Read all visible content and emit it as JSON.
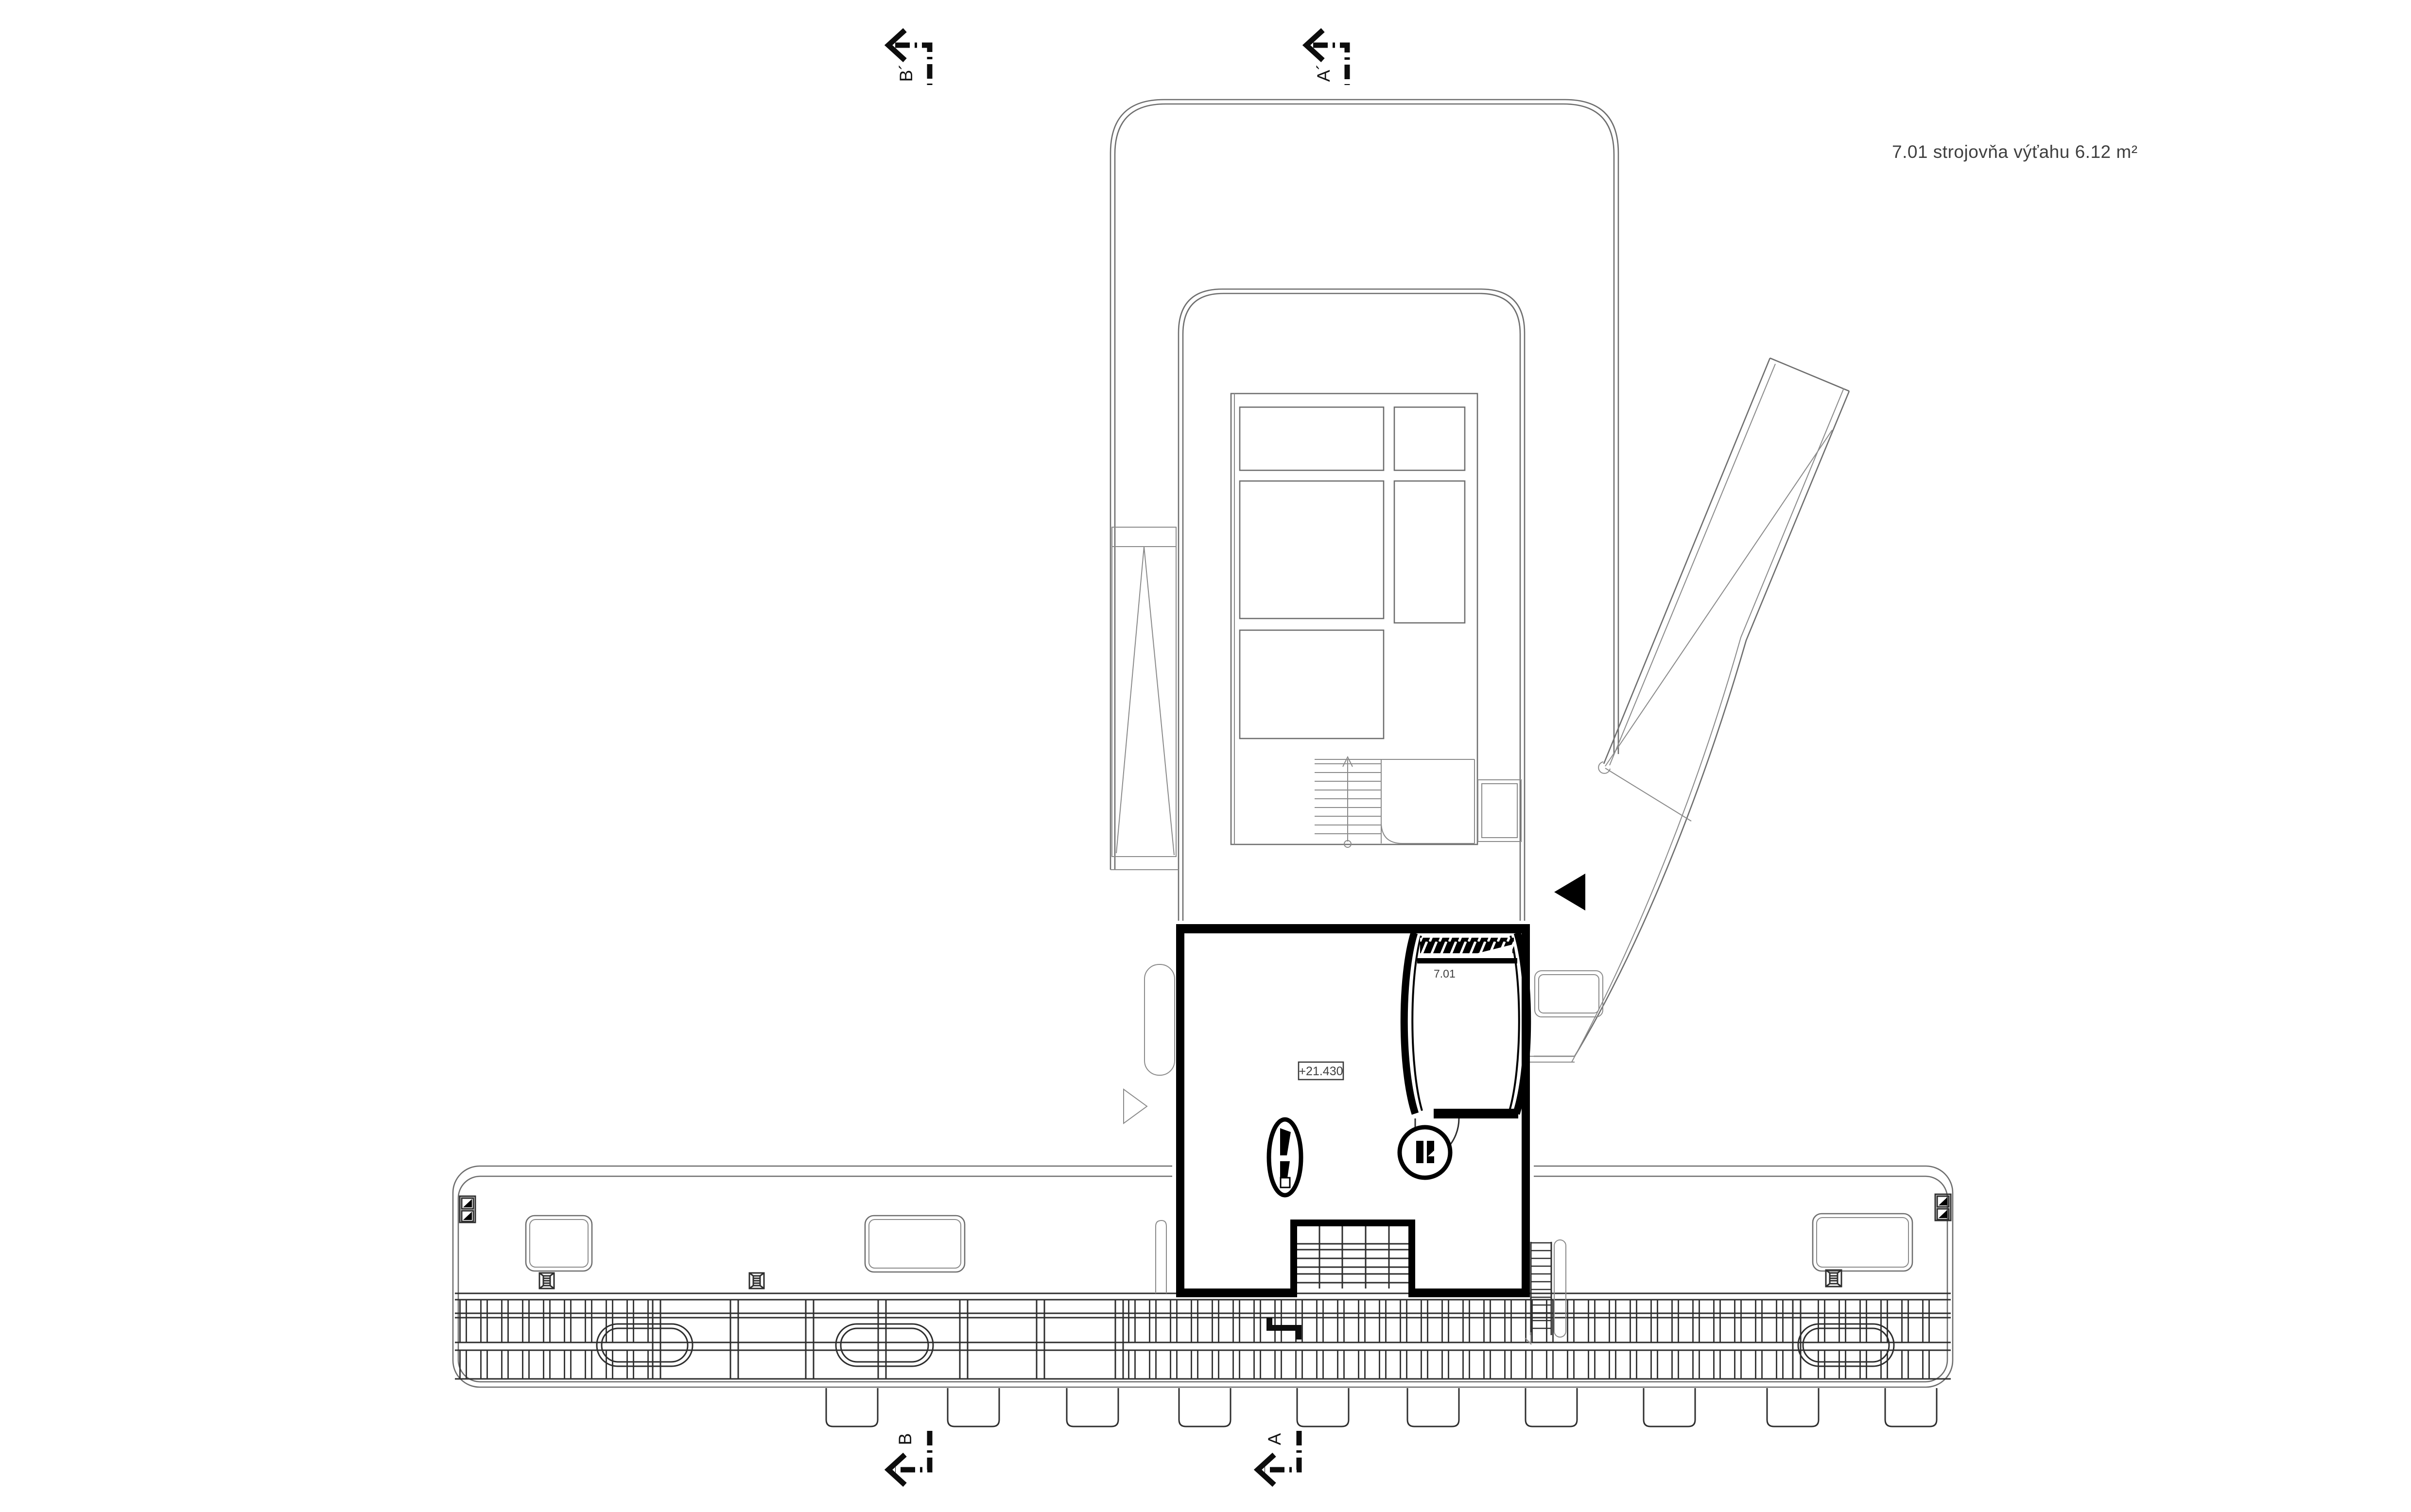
{
  "title_label": "7.01 strojovňa výťahu 6.12 m²",
  "room": {
    "number": "7.01",
    "elevation": "+21.430"
  },
  "section_markers": {
    "top_left": "B´",
    "top_mid": "A´",
    "bottom_left": "B",
    "bottom_mid": "A"
  },
  "colors": {
    "background": "#ffffff",
    "thin_line": "#6e6e6e",
    "detail_line": "#2e2e2e",
    "wall": "#000000",
    "text": "#3f3f3f"
  }
}
